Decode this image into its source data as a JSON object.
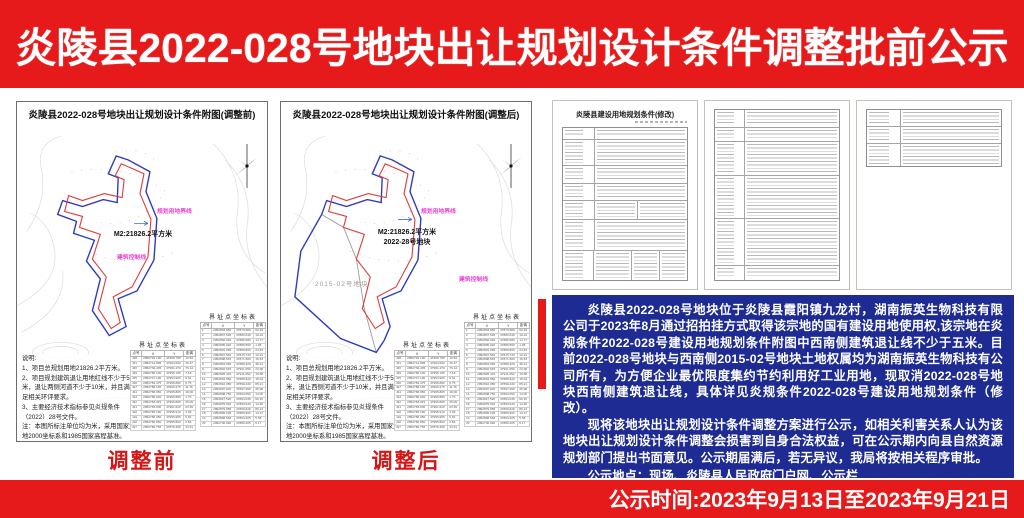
{
  "banner": {
    "title": "炎陵县2022-028号地块出让规划设计条件调整批前公示",
    "bottom_text": "公示时间:2023年9月13日至2023年9月21日"
  },
  "map_before": {
    "title": "炎陵县2022-028号地块出让规划设计条件附图(调整前)",
    "area_label": "M2:21826.2平方米",
    "legend_planning": "规划用地界线",
    "legend_control": "建筑控制线",
    "coord_table_title": "界址点坐标表",
    "notes": [
      "说明:",
      "1、项目总规划用地21826.2平方米。",
      "2、项目规划建筑退让用地红线不少于5米，退让两侧河道不少于10米，并且满足相关环评要求。",
      "3、主要经济技术指标参见炎规条件（2022）28号文件。",
      "注：本图所标注单位均为米，采用国家大地2000坐标系和1985国家高程基准。"
    ],
    "caption": "调整前"
  },
  "map_after": {
    "title": "炎陵县2022-028号地块出让规划设计条件附图(调整后)",
    "area_label": "M2:21826.2平方米",
    "area_label2": "2022-28号地块",
    "neighbor_label": "2015-02号地块",
    "legend_planning": "规划用地界线",
    "legend_control": "建筑控制线",
    "coord_table_title": "界址点坐标表",
    "notes": [
      "说明:",
      "1、项目总规划用地21826.2平方米。",
      "2、项目规划建筑退让用地红线不少于5米，退让西侧河道不少于10米，并且满足相关环评要求。",
      "3、主要经济技术指标参见炎规条件（2022）28号文件。",
      "注：本图所标注单位均为米，采用国家大地2000坐标系和1985国家高程基准。"
    ],
    "caption": "调整后"
  },
  "coords": {
    "headers": [
      "点号",
      "X",
      "Y",
      "距离"
    ],
    "rows_a": [
      [
        "J28",
        "2952794.190",
        "47968.765",
        "13.54"
      ],
      [
        "J31",
        "2952714.805",
        "47964.590",
        "15.47"
      ],
      [
        "J30",
        "2952736.435",
        "47961.270",
        "76.14"
      ],
      [
        "J29",
        "2952756.190",
        "47955.765",
        "7.18"
      ],
      [
        "J25",
        "2952747.190",
        "47954.905",
        "9.61"
      ],
      [
        "J26",
        "2952754.475",
        "47955.880",
        "6.75"
      ],
      [
        "J27",
        "2952758.195",
        "47960.270",
        "11.76"
      ],
      [
        "J24",
        "2952768.050",
        "47965.805",
        "18.09"
      ],
      [
        "J23",
        "2952768.040",
        "47965.880",
        "1.73"
      ],
      [
        "J22",
        "2952763.415",
        "47966.805",
        "25.09"
      ],
      [
        "J21",
        "2952763.030",
        "47961.620",
        "23.39"
      ],
      [
        "J20",
        "2952765.180",
        "47955.910",
        "4.68"
      ],
      [
        "J19",
        "2952768.050",
        "47955.905",
        "5.82"
      ],
      [
        "J18",
        "2952766.050",
        "47955.860",
        "2.66"
      ],
      [
        "J17",
        "2952766.756",
        "47876.390",
        "13.51"
      ]
    ],
    "rows_b": [
      [
        "1",
        "2952804.050",
        "47879.580",
        "52.93"
      ],
      [
        "2",
        "2952807.525",
        "47880.630",
        "19.24"
      ],
      [
        "3",
        "2952802.040",
        "47886.580",
        "14.77"
      ],
      [
        "4",
        "2952805.040",
        "47886.550",
        "1.08"
      ],
      [
        "5",
        "2952801.050",
        "47880.800",
        "24.63"
      ],
      [
        "6",
        "2952807.540",
        "47875.730",
        "10.24"
      ],
      [
        "7",
        "2952808.515",
        "47871.580",
        "15.54"
      ],
      [
        "8",
        "2952804.050",
        "47889.420",
        "38.21"
      ],
      [
        "9",
        "2952802.515",
        "47901.050",
        "22.08"
      ],
      [
        "10",
        "2952825.415",
        "47911.050",
        "16.58"
      ],
      [
        "11",
        "2952804.050",
        "47889.920",
        "15.04"
      ],
      [
        "12",
        "2952816.050",
        "47899.430",
        "65.21"
      ],
      [
        "13",
        "2952807.920",
        "47897.050",
        "45.08"
      ],
      [
        "14",
        "2952808.750",
        "47894.050",
        "14.06"
      ],
      [
        "15",
        "2952847.520",
        "47894.045",
        "60.10"
      ],
      [
        "16",
        "2952879.540",
        "47893.940",
        "14.68"
      ],
      [
        "17",
        "2952879.055",
        "47890.620",
        "80.13"
      ],
      [
        "18",
        "2952806.190",
        "47889.962",
        "14.17"
      ],
      [
        "19",
        "2952808.548",
        "47894.205",
        "5.58"
      ],
      [
        "20",
        "2952736.990",
        "47886.205",
        "0.17"
      ]
    ]
  },
  "documents": {
    "page1_title": "炎陵县建设用地规划条件(修改)"
  },
  "notice": {
    "paragraphs": [
      "炎陵县2022-028号地块位于炎陵县霞阳镇九龙村，湖南振英生物科技有限公司于2023年8月通过招拍挂方式取得该宗地的国有建设用地使用权,该宗地在炎规条件2022-028号建设用地规划条件附图中西南侧建筑退让线不少于五米。目前2022-028号地块与西南侧2015-02号地块土地权属均为湖南振英生物科技有公司所有，为方便企业最优限度集约节约利用好工业用地，现取消2022-028号地块西南侧建筑退让线，具体详见炎规条件2022-028号建设用地规划条件（修改）。",
      "现将该地块出让规划设计条件调整方案进行公示，如相关利害关系人认为该地块出让规划设计条件调整会损害到自身合法权益，可在公示期内向县自然资源规划部门提出书面意见。公示期届满后，若无异议，我局将按相关程序审批。"
    ],
    "lines": [
      "公示地点：现场、炎陵县人民政府门户网、公示栏",
      "公示时间：2023年9月13日至2023年9月21日"
    ],
    "phone_line": "联系电话：0731-22027872",
    "signature": "炎陵县自然资源局"
  }
}
